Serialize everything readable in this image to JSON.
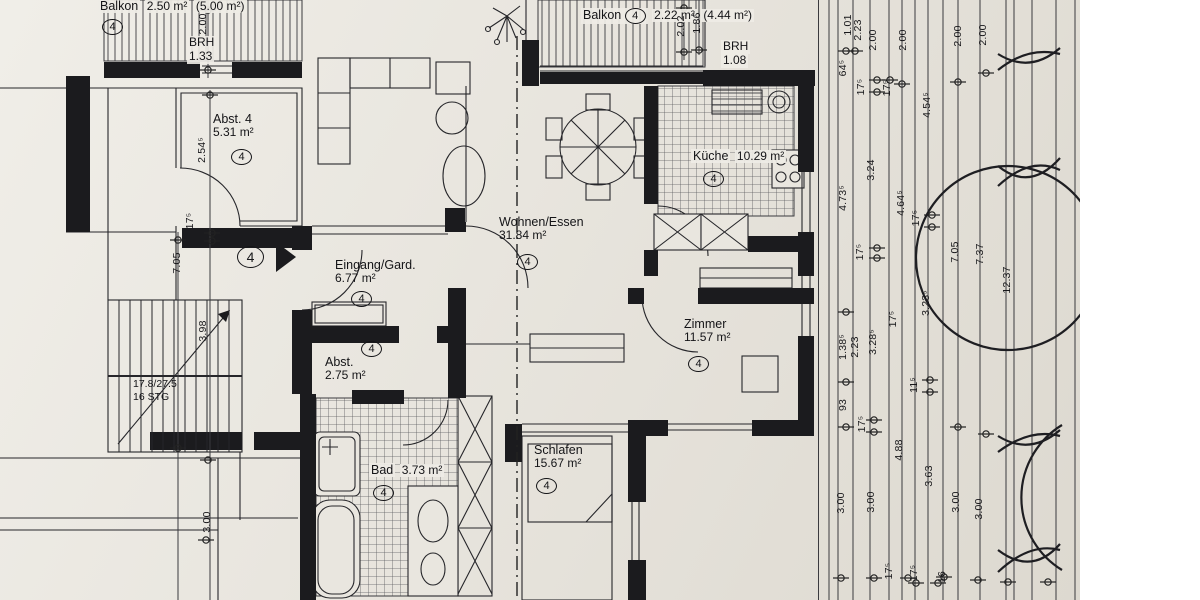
{
  "colors": {
    "paper": "#e8e5de",
    "ink": "#1b1b1e"
  },
  "rooms": {
    "balkon_left": {
      "name": "Balkon",
      "area": "2.50 m²",
      "area_total": "(5.00 m²)",
      "tag": "4",
      "brh": {
        "label": "BRH",
        "value": "1.33"
      }
    },
    "balkon_top": {
      "name": "Balkon",
      "area": "2.22 m²",
      "area_total": "(4.44 m²)",
      "tag": "4",
      "brh": {
        "label": "BRH",
        "value": "1.08"
      }
    },
    "abst4": {
      "name": "Abst. 4",
      "area": "5.31 m²",
      "tag": "4"
    },
    "eingang": {
      "name": "Eingang/Gard.",
      "area": "6.77 m²",
      "tag": "4"
    },
    "wohnen": {
      "name": "Wohnen/Essen",
      "area": "31.84 m²",
      "tag": "4"
    },
    "kueche": {
      "name": "Küche",
      "area": "10.29 m²",
      "tag": "4"
    },
    "zimmer": {
      "name": "Zimmer",
      "area": "11.57 m²",
      "tag": "4"
    },
    "abst275": {
      "name": "Abst.",
      "area": "2.75 m²",
      "tag": "4"
    },
    "bad": {
      "name": "Bad",
      "area": "3.73 m²",
      "tag": "4"
    },
    "schlafen": {
      "name": "Schlafen",
      "area": "15.67 m²",
      "tag": "4"
    }
  },
  "entrance": {
    "tag": "4"
  },
  "stairs": {
    "line1": "17.8/27.5",
    "line2": "16 STG"
  },
  "dimensions": [
    [
      "2.00",
      203,
      24
    ],
    [
      "2.54⁵",
      202,
      150
    ],
    [
      "17⁵",
      190,
      221
    ],
    [
      "7.05",
      177,
      263
    ],
    [
      "3.98",
      203,
      331
    ],
    [
      "3.00",
      207,
      522
    ],
    [
      "2.02",
      681,
      26
    ],
    [
      "1.86",
      697,
      23
    ],
    [
      "1.01",
      848,
      25
    ],
    [
      "2.23",
      858,
      30
    ],
    [
      "2.00",
      873,
      40
    ],
    [
      "2.00",
      903,
      40
    ],
    [
      "2.00",
      958,
      36
    ],
    [
      "2.00",
      983,
      35
    ],
    [
      "64⁵",
      843,
      68
    ],
    [
      "17⁵",
      861,
      87
    ],
    [
      "17⁵",
      887,
      88
    ],
    [
      "4.54⁵",
      927,
      105
    ],
    [
      "4.73⁵",
      843,
      198
    ],
    [
      "3.24",
      871,
      170
    ],
    [
      "4.64⁵",
      901,
      203
    ],
    [
      "17⁵",
      916,
      218
    ],
    [
      "17⁵",
      860,
      252
    ],
    [
      "7.05",
      955,
      252
    ],
    [
      "7.37",
      980,
      254
    ],
    [
      "12.37",
      1007,
      280
    ],
    [
      "3.23⁵",
      926,
      303
    ],
    [
      "1.38⁵",
      843,
      347
    ],
    [
      "2.23",
      855,
      347
    ],
    [
      "3.28⁵",
      873,
      342
    ],
    [
      "17⁵",
      893,
      319
    ],
    [
      "93",
      843,
      405
    ],
    [
      "17⁵",
      862,
      424
    ],
    [
      "11⁵",
      914,
      385
    ],
    [
      "4.88",
      899,
      450
    ],
    [
      "3.00",
      841,
      503
    ],
    [
      "3.00",
      871,
      502
    ],
    [
      "3.63",
      929,
      476
    ],
    [
      "3.00",
      956,
      502
    ],
    [
      "3.00",
      979,
      509
    ],
    [
      "17⁵",
      889,
      571
    ],
    [
      "17⁵",
      914,
      573
    ],
    [
      "16",
      942,
      577
    ]
  ]
}
